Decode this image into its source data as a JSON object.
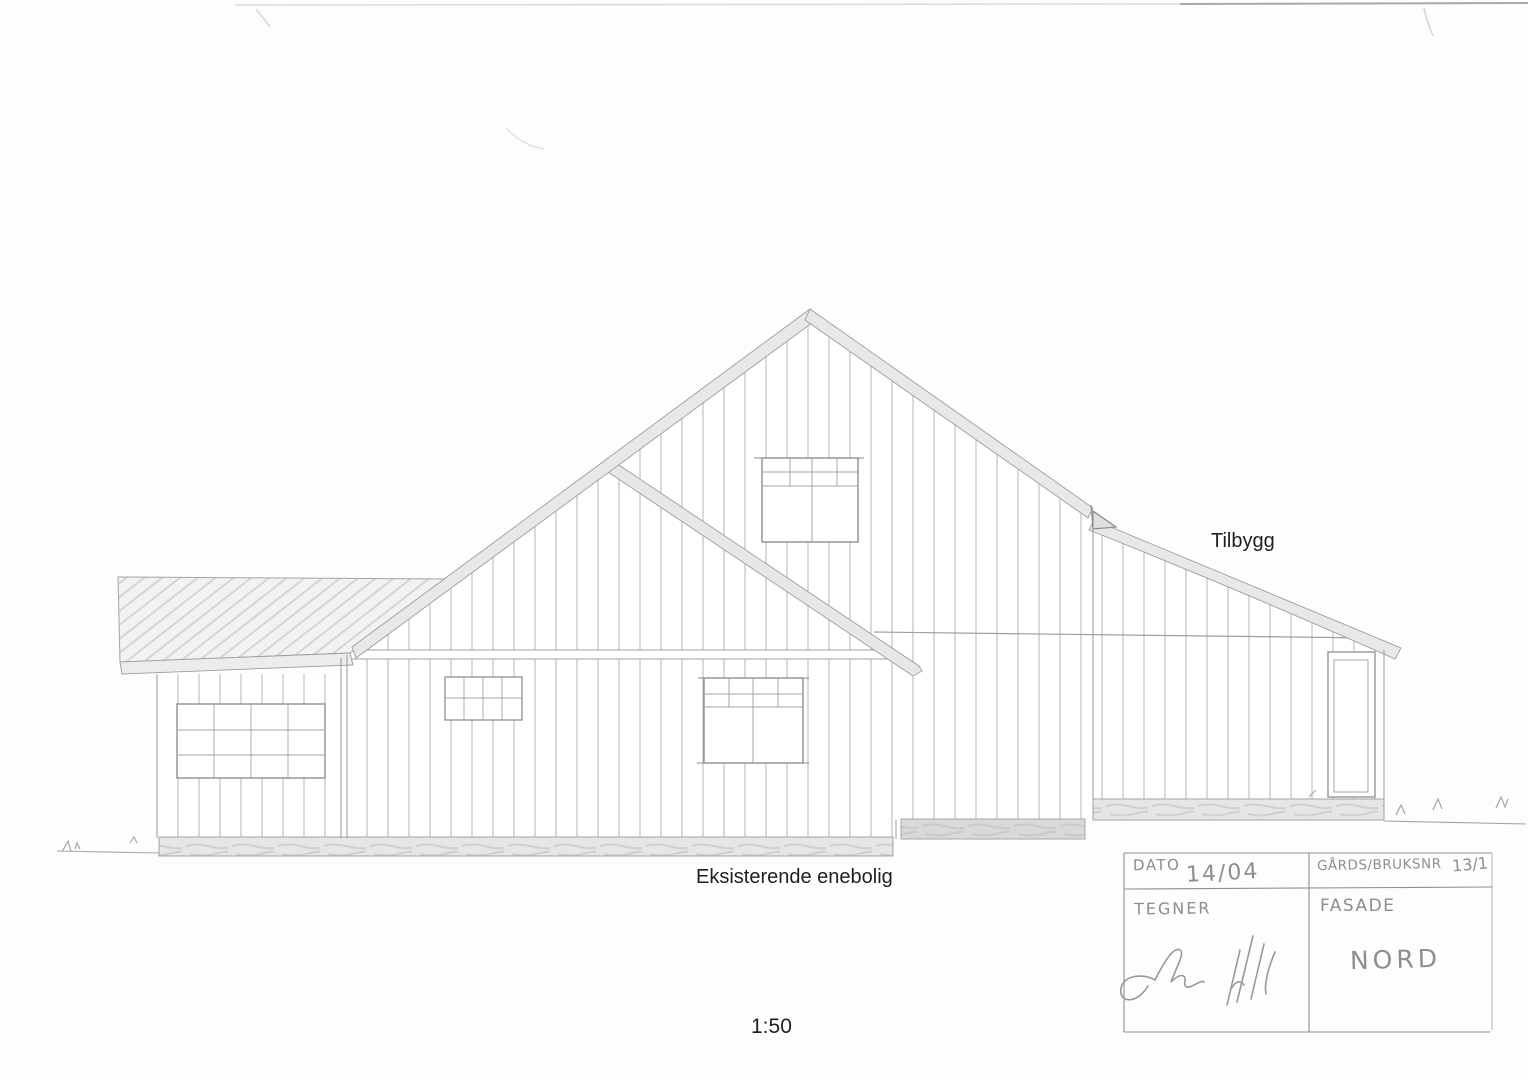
{
  "drawing": {
    "labels": {
      "addition": "Tilbygg",
      "existing": "Eksisterende enebolig",
      "scale": "1:50"
    },
    "title_block": {
      "date_label": "DATO",
      "date_value": "14/04",
      "parcel_label": "GÅRDS/BRUKSNR",
      "parcel_value": "13/1",
      "drawn_by_label": "TEGNER",
      "view_label": "FASADE",
      "view_value": "NORD"
    },
    "colors": {
      "pencil": "#9a9a9a",
      "pencil_light": "#b6b6b6",
      "label_ink": "#1f1f1f",
      "paper": "#fdfdfd"
    }
  }
}
